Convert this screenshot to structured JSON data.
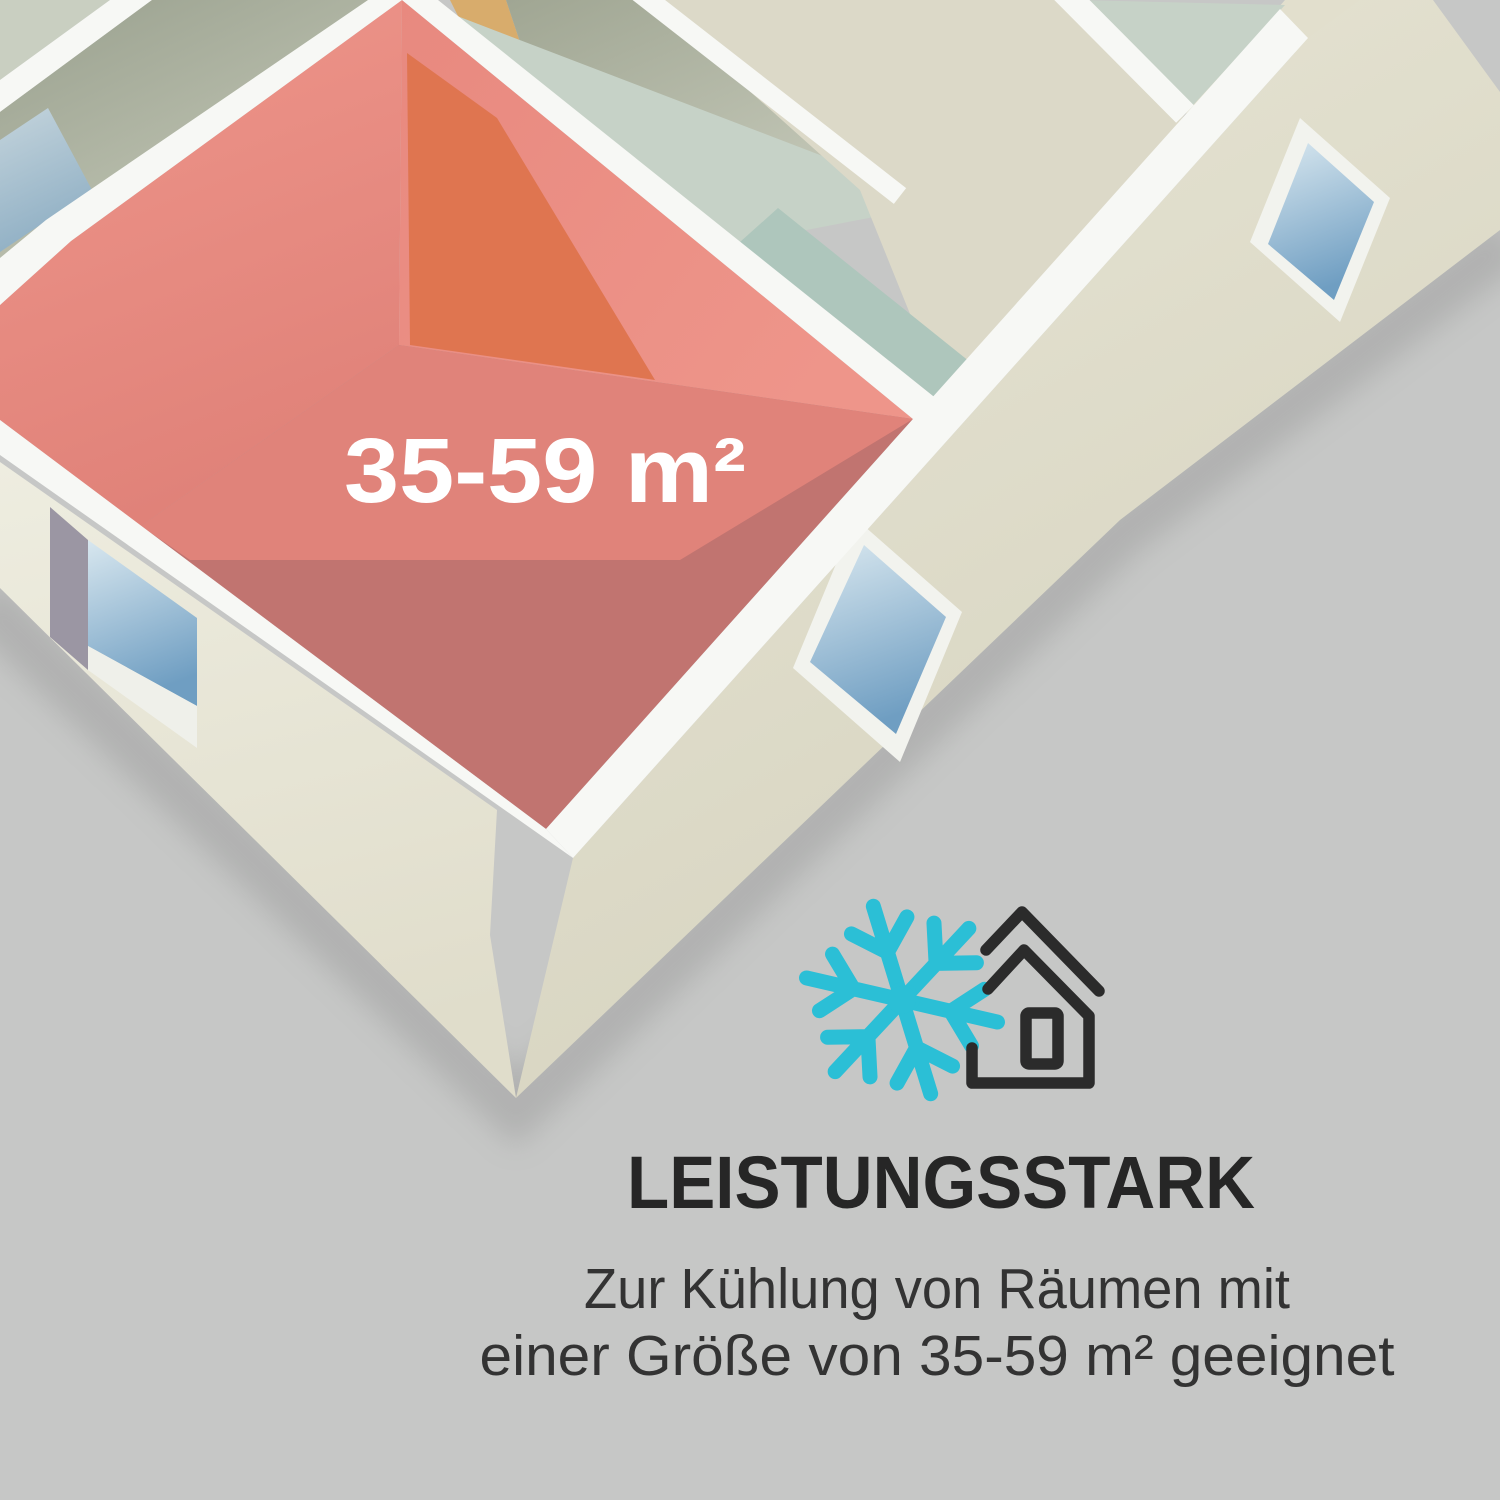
{
  "illustration": {
    "room_label": "35-59 m²",
    "icons": {
      "snowflake": "snowflake-icon",
      "house": "house-icon"
    }
  },
  "feature": {
    "heading": "LEISTUNGSSTARK",
    "description_line1": "Zur Kühlung von Räumen mit",
    "description_line2": "einer Größe von 35-59 m² geeignet"
  },
  "colors": {
    "background": "#c6c7c6",
    "wall_top": "#f7f8f5",
    "wall_cream": "#e7e4d4",
    "room_highlight": "#e68a80",
    "room_floor_shade": "#c17470",
    "room_floor_light": "#e0837a",
    "door_accent": "#df7550",
    "window_glass": "#7fa6c5",
    "window_jamb": "#9b96a3",
    "back_room_sage": "#a3a996",
    "back_room_mint": "#c6d2c7",
    "back_room_beige": "#dcd9c8",
    "hallway_teal": "#aec6bc",
    "back_door_tan": "#d8ac6c",
    "snowflake_cyan": "#2bbfd6",
    "icon_outline": "#2b2b2b",
    "heading_text": "#262626",
    "body_text": "#333333",
    "room_label_text": "#ffffff"
  }
}
